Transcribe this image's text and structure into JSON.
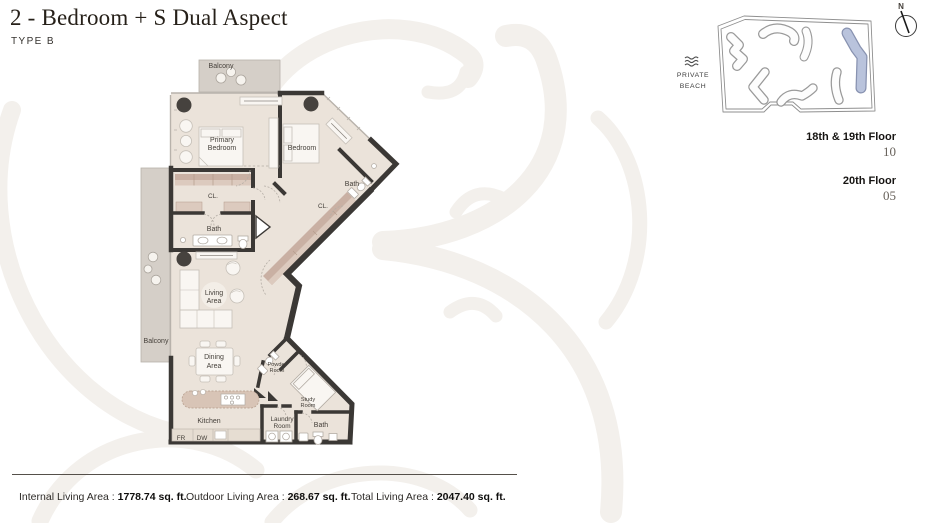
{
  "header": {
    "title": "2 - Bedroom + S Dual Aspect",
    "subtitle": "TYPE B"
  },
  "floorplan": {
    "rooms": {
      "balcony_top": "Balcony",
      "balcony_left": "Balcony",
      "primary_bedroom": [
        "Primary",
        "Bedroom"
      ],
      "bedroom": "Bedroom",
      "closet_left": "CL.",
      "closet_hall": "CL.",
      "bath_closet": "Bath",
      "bath_ensuite": "Bath",
      "bath_wing": "Bath",
      "living": [
        "Living",
        "Area"
      ],
      "dining": [
        "Dining",
        "Area"
      ],
      "kitchen": "Kitchen",
      "fridge": "FR",
      "dishwasher": "DW",
      "powder": [
        "Powder",
        "Room"
      ],
      "study": [
        "Study",
        "Room"
      ],
      "laundry": [
        "Laundry",
        "Room"
      ]
    }
  },
  "site": {
    "beach_line1": "PRIVATE",
    "beach_line2": "BEACH",
    "compass_label": "N",
    "highlight_color": "#b9c3dc"
  },
  "floors": [
    {
      "label": "18th & 19th Floor",
      "unit": "10"
    },
    {
      "label": "20th Floor",
      "unit": "05"
    }
  ],
  "stats": [
    {
      "label": "Internal Living Area : ",
      "value": "1778.74 sq. ft."
    },
    {
      "label": "Outdoor Living Area : ",
      "value": "268.67 sq. ft."
    },
    {
      "label": "Total Living Area : ",
      "value": "2047.40 sq. ft."
    }
  ],
  "colors": {
    "wall": "#3b3835",
    "floor": "#ebe3da",
    "wardrobe_dark": "#c9b0a3",
    "wardrobe_light": "#dccabe",
    "balcony": "#d5cfc8",
    "watermark": "#f3f0ec",
    "site_highlight": "#b9c3dc"
  }
}
